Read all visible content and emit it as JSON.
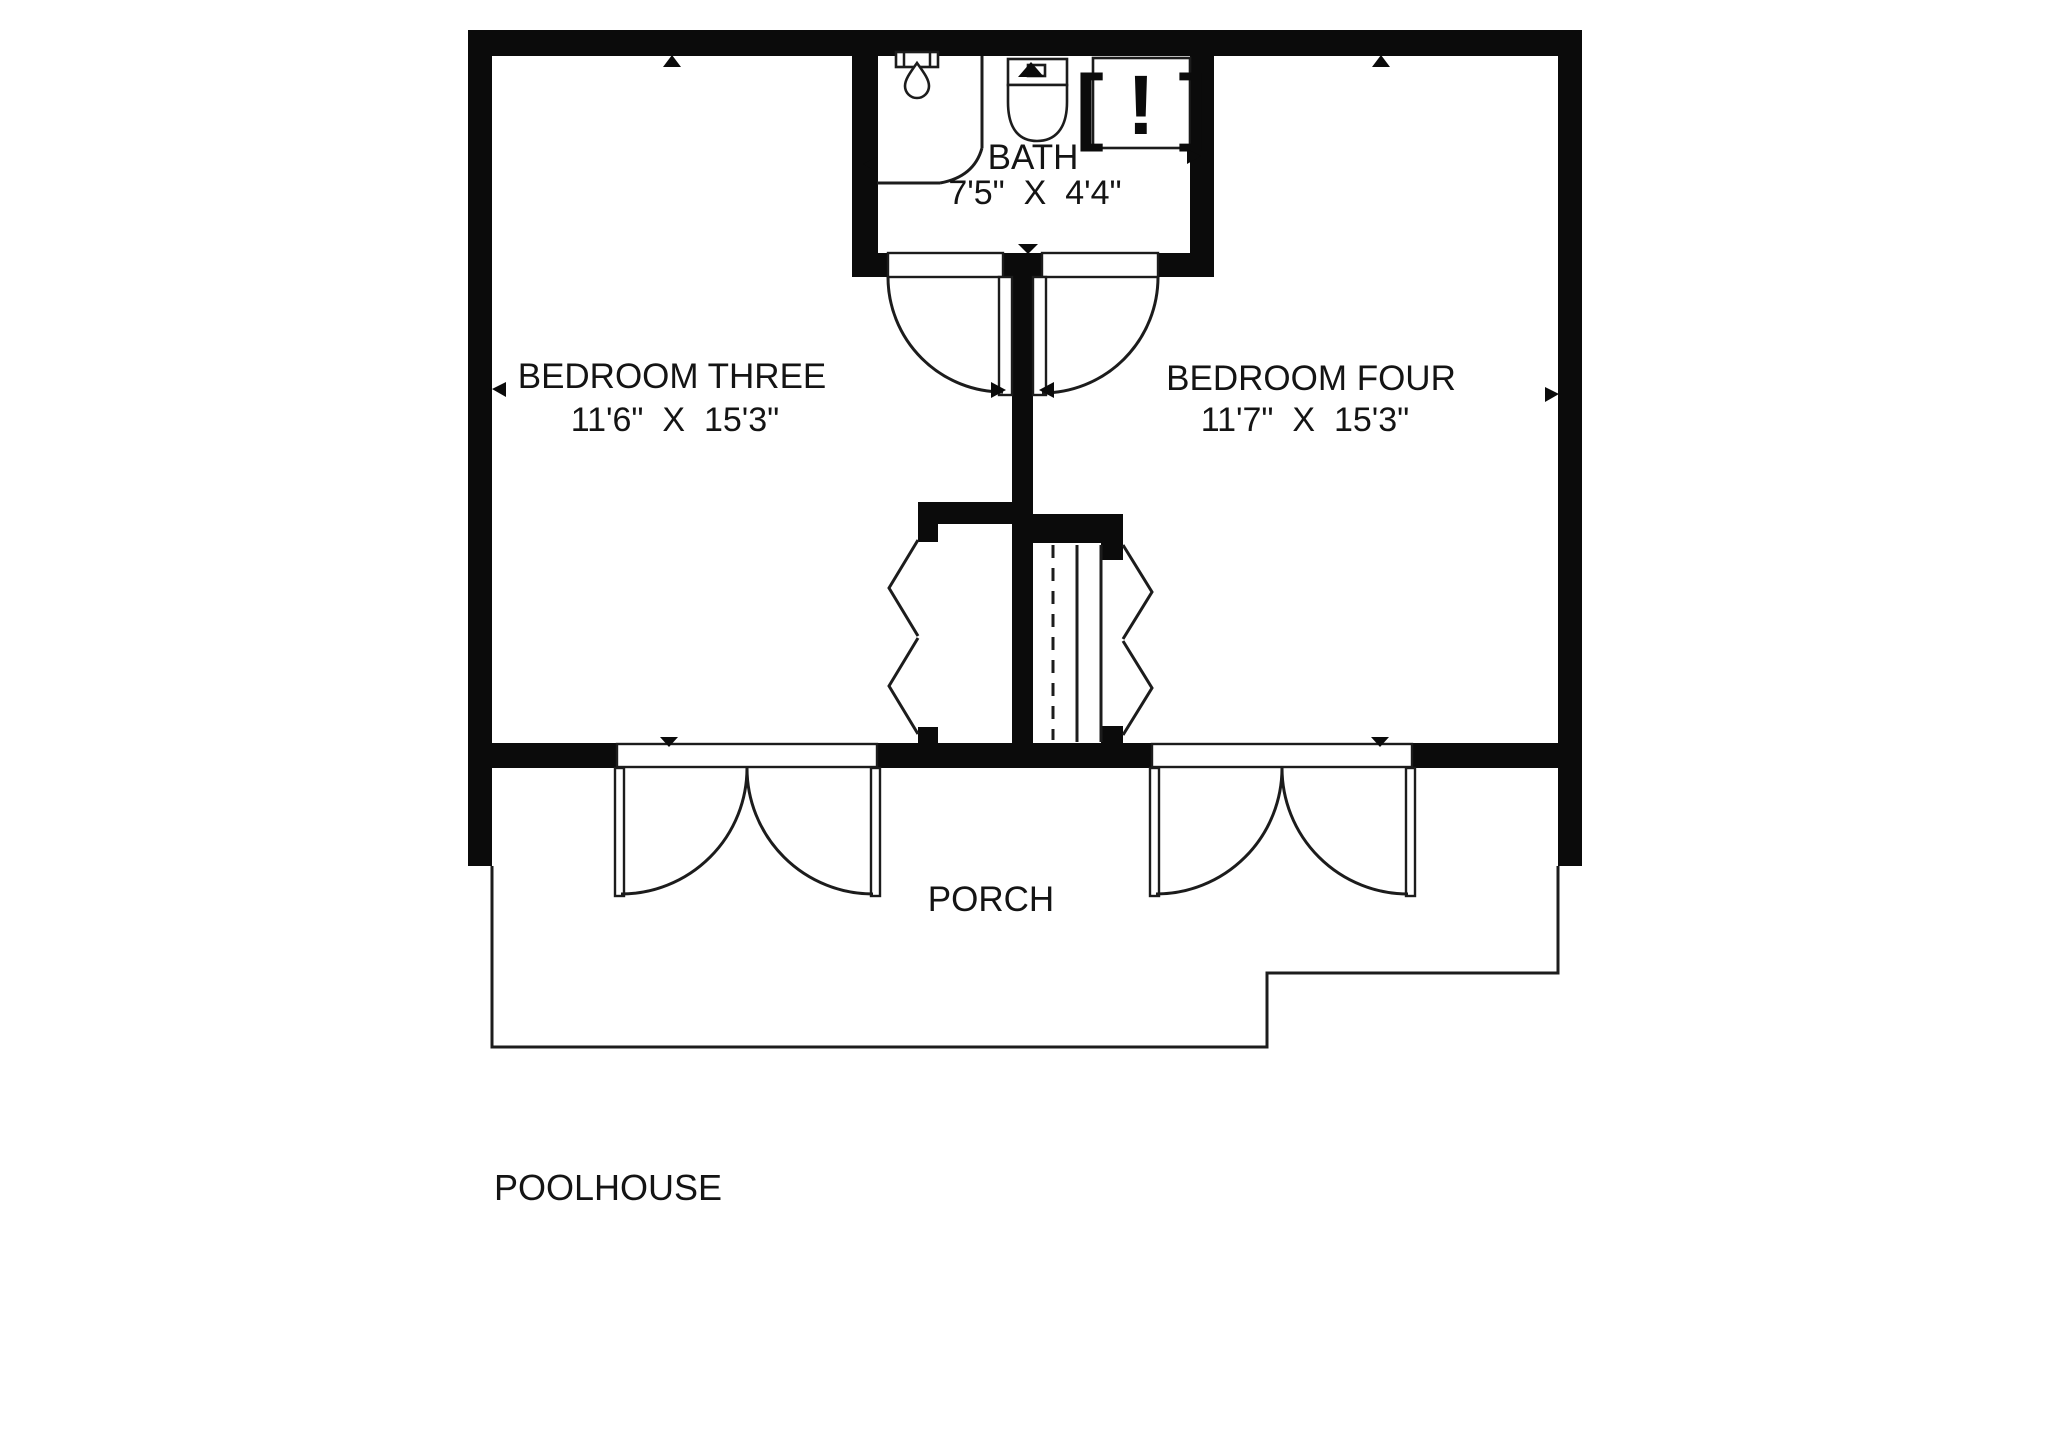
{
  "title": "POOLHOUSE",
  "colors": {
    "wall": "#0b0b0b",
    "line": "#1c1c1c",
    "background": "#ffffff"
  },
  "rooms": {
    "bedroom_three": {
      "name": "BEDROOM THREE",
      "dimensions": "11'6\"  X  15'3\""
    },
    "bedroom_four": {
      "name": "BEDROOM FOUR",
      "dimensions": "11'7\"  X  15'3\""
    },
    "bath": {
      "name": "BATH",
      "dimensions": "7'5\"  X  4'4\""
    },
    "porch": {
      "name": "PORCH"
    }
  },
  "symbols": {
    "unknown_fixture": "[ ! ]"
  }
}
